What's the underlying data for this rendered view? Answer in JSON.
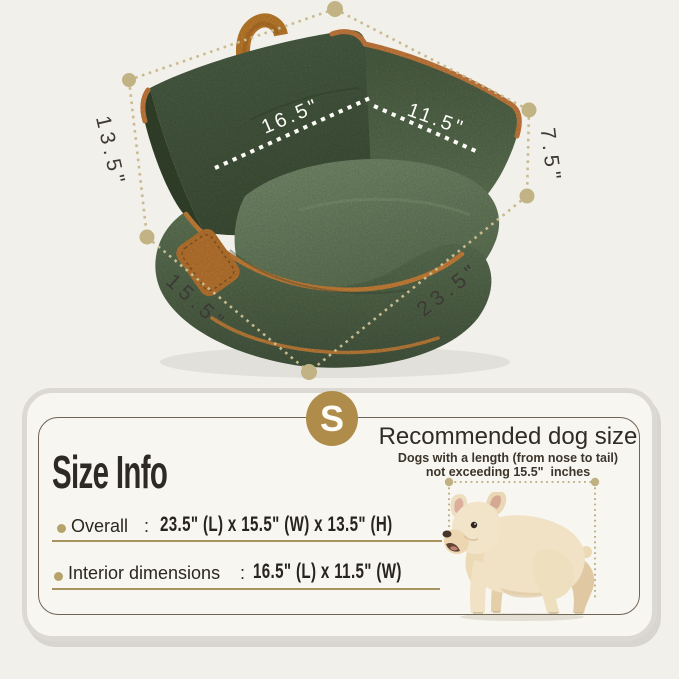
{
  "photo": {
    "dimensions": {
      "interior_length": "16.5\"",
      "interior_width": "11.5\"",
      "back_height": "13.5\"",
      "front_height": "7.5\"",
      "width": "15.5\"",
      "length": "23.5\""
    }
  },
  "info_card": {
    "size_badge": "S",
    "title": "Size Info",
    "recommended": {
      "title": "Recommended dog size",
      "line1": "Dogs with a length (from nose to tail)",
      "line2": "not exceeding 15.5\"  inches"
    },
    "rows": [
      {
        "label": "Overall",
        "colon": ":",
        "value": "23.5\" (L) x 15.5\" (W) x 13.5\" (H)"
      },
      {
        "label": "Interior dimensions",
        "colon": ":",
        "value": "16.5\" (L) x 11.5\" (W)"
      }
    ]
  },
  "colors": {
    "accent_gold": "#b08c4b",
    "underline_gold": "#a6935e",
    "dotted_line_tan": "#c9bb8f",
    "bed_green": "#5d7355",
    "trim_orange": "#c5812f"
  }
}
